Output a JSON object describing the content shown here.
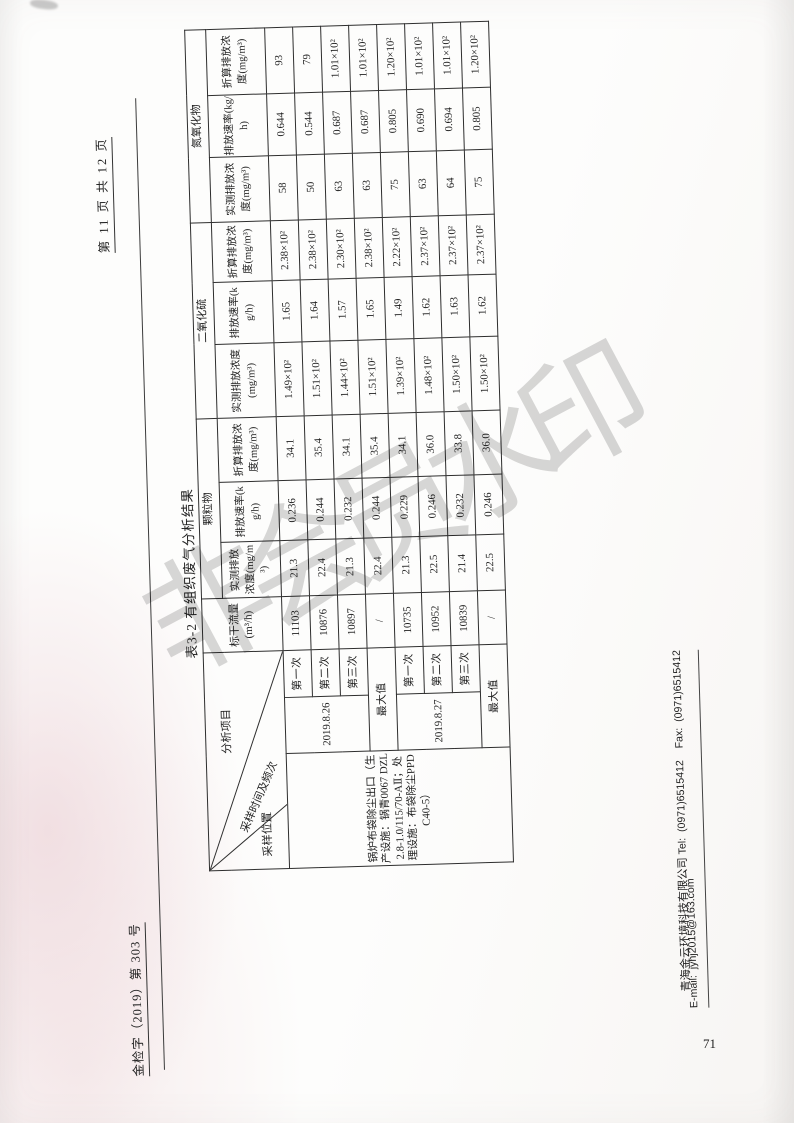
{
  "header": {
    "doc_number": "金检字（2019）第 303 号",
    "page_indicator": "第 11 页 共 12 页"
  },
  "watermark": {
    "text": "非会员水印"
  },
  "page_number": "71",
  "table": {
    "title": "表3-2 有组织废气分析结果",
    "corner": {
      "top": "分析项目",
      "middle": "采样时间及频次",
      "bottom": "采样位置"
    },
    "flow_header": {
      "label": "标干流量",
      "unit": "(m³/h)"
    },
    "groups": [
      {
        "name": "颗粒物",
        "cols": [
          "实测排放浓度(mg/m³)",
          "排放速率(kg/h)",
          "折算排放浓度(mg/m³)"
        ]
      },
      {
        "name": "二氧化硫",
        "cols": [
          "实测排放浓度(mg/m³)",
          "排放速率(kg/h)",
          "折算排放浓度(mg/m³)"
        ]
      },
      {
        "name": "氮氧化物",
        "cols": [
          "实测排放浓度(mg/m³)",
          "排放速率(kg/h)",
          "折算排放浓度(mg/m³)"
        ]
      }
    ],
    "location": "锅炉布袋除尘出口（生产设施：锅青0067 DZL2.8-1.0/115/70-AⅡ；处理设施：布袋除尘PPDC40-5）",
    "dates": [
      "2019.8.26",
      "2019.8.27"
    ],
    "rows": [
      {
        "seq": "第一次",
        "flow": "11103",
        "pm": [
          "21.3",
          "0.236",
          "34.1"
        ],
        "so2": [
          "1.49×10²",
          "1.65",
          "2.38×10²"
        ],
        "nox": [
          "58",
          "0.644",
          "93"
        ]
      },
      {
        "seq": "第二次",
        "flow": "10876",
        "pm": [
          "22.4",
          "0.244",
          "35.4"
        ],
        "so2": [
          "1.51×10²",
          "1.64",
          "2.38×10²"
        ],
        "nox": [
          "50",
          "0.544",
          "79"
        ]
      },
      {
        "seq": "第三次",
        "flow": "10897",
        "pm": [
          "21.3",
          "0.232",
          "34.1"
        ],
        "so2": [
          "1.44×10²",
          "1.57",
          "2.30×10²"
        ],
        "nox": [
          "63",
          "0.687",
          "1.01×10²"
        ]
      },
      {
        "seq": "最大值",
        "flow": "/",
        "pm": [
          "22.4",
          "0.244",
          "35.4"
        ],
        "so2": [
          "1.51×10²",
          "1.65",
          "2.38×10²"
        ],
        "nox": [
          "63",
          "0.687",
          "1.01×10²"
        ]
      },
      {
        "seq": "第一次",
        "flow": "10735",
        "pm": [
          "21.3",
          "0.229",
          "34.1"
        ],
        "so2": [
          "1.39×10²",
          "1.49",
          "2.22×10²"
        ],
        "nox": [
          "75",
          "0.805",
          "1.20×10²"
        ]
      },
      {
        "seq": "第二次",
        "flow": "10952",
        "pm": [
          "22.5",
          "0.246",
          "36.0"
        ],
        "so2": [
          "1.48×10²",
          "1.62",
          "2.37×10²"
        ],
        "nox": [
          "63",
          "0.690",
          "1.01×10²"
        ]
      },
      {
        "seq": "第三次",
        "flow": "10839",
        "pm": [
          "21.4",
          "0.232",
          "33.8"
        ],
        "so2": [
          "1.50×10²",
          "1.63",
          "2.37×10²"
        ],
        "nox": [
          "64",
          "0.694",
          "1.01×10²"
        ]
      },
      {
        "seq": "最大值",
        "flow": "/",
        "pm": [
          "22.5",
          "0.246",
          "36.0"
        ],
        "so2": [
          "1.50×10²",
          "1.62",
          "2.37×10²"
        ],
        "nox": [
          "75",
          "0.805",
          "1.20×10²"
        ]
      }
    ]
  },
  "footer": {
    "company": "青海金云环境科技有限公司",
    "contact": " Tel:  (0971)6515412    Fax:  (0971)6515412",
    "email": "E-mail:  jyhj2015@163.com"
  }
}
